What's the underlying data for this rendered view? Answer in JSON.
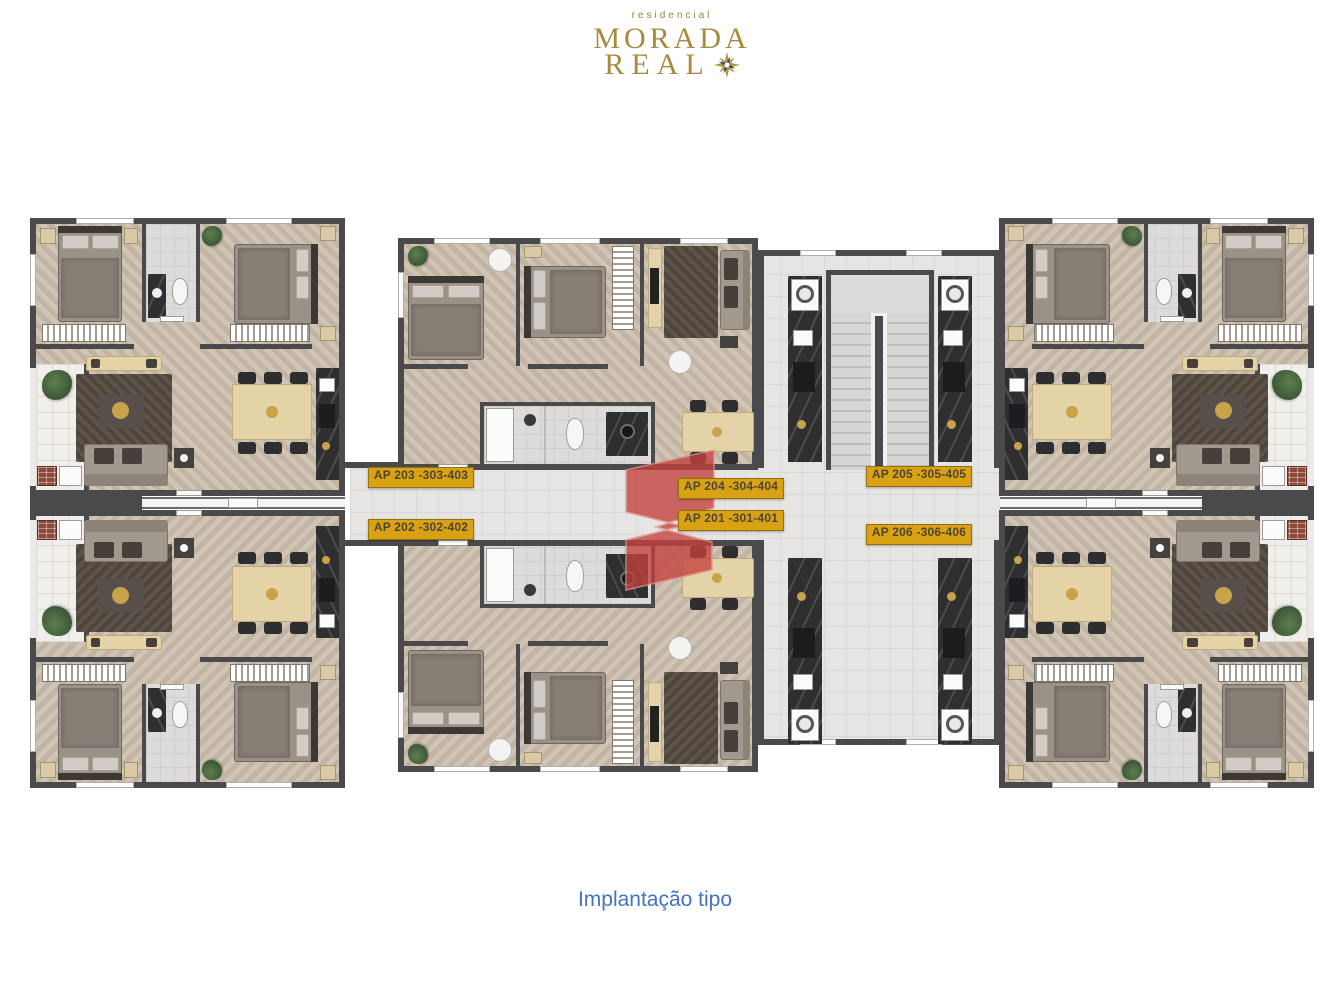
{
  "logo": {
    "tagline": "residencial",
    "title_line1": "MORADA",
    "title_line2": "REAL",
    "icon": "star-burst-icon",
    "gold_color": "#a98a3c",
    "star_blue_color": "#2a4676"
  },
  "caption": {
    "text": "Implantação tipo",
    "color": "#4472c4"
  },
  "watermark": {
    "letter": "S",
    "color": "#c4423d"
  },
  "floor_plan": {
    "label_style": {
      "background": "#d8a212",
      "text_color": "#4e4536"
    },
    "apartments": [
      {
        "id": "ap-203",
        "label": "AP 203 -303-403"
      },
      {
        "id": "ap-202",
        "label": "AP 202 -302-402"
      },
      {
        "id": "ap-204",
        "label": "AP 204 -304-404"
      },
      {
        "id": "ap-201",
        "label": "AP 201 -301-401"
      },
      {
        "id": "ap-205",
        "label": "AP 205 -305-405"
      },
      {
        "id": "ap-206",
        "label": "AP 206 -306-406"
      }
    ]
  }
}
